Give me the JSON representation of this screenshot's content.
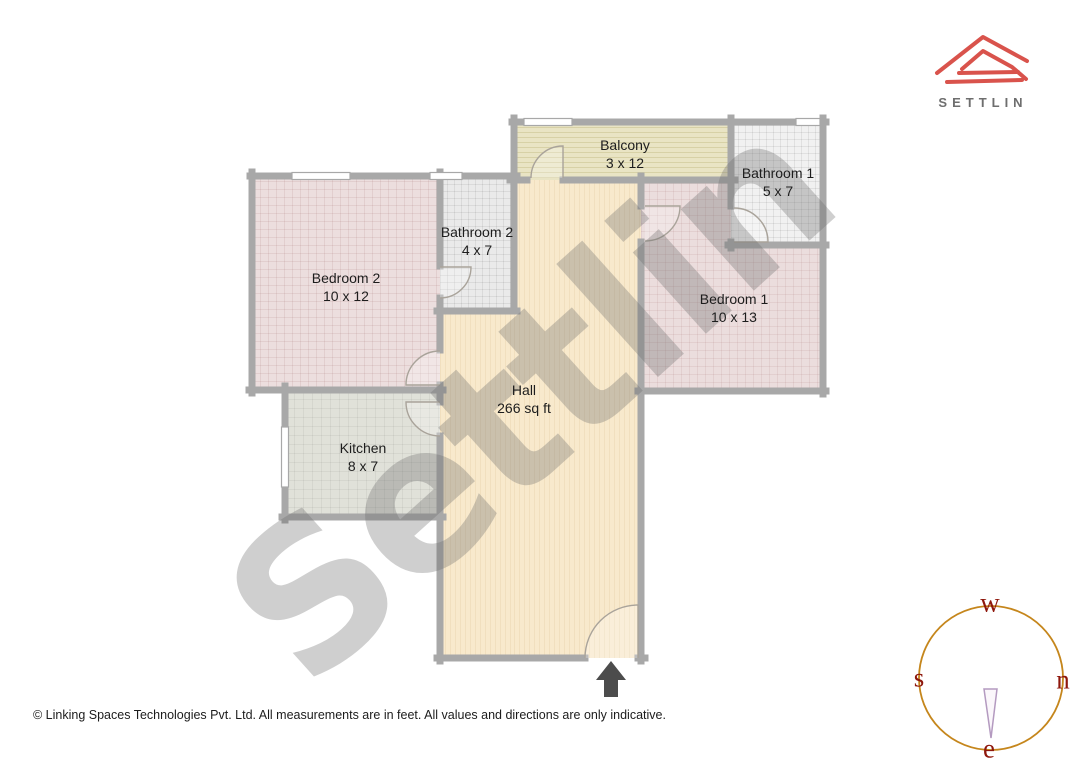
{
  "brand": {
    "name": "SETTLIN"
  },
  "watermark": "Settlin",
  "rooms": [
    {
      "name": "Balcony",
      "dims": "3 x 12"
    },
    {
      "name": "Bathroom 1",
      "dims": "5 x 7"
    },
    {
      "name": "Bathroom 2",
      "dims": "4 x 7"
    },
    {
      "name": "Bedroom 2",
      "dims": "10 x 12"
    },
    {
      "name": "Bedroom 1",
      "dims": "10 x 13"
    },
    {
      "name": "Kitchen",
      "dims": "8 x 7"
    },
    {
      "name": "Hall",
      "dims": "266 sq ft"
    }
  ],
  "compass": {
    "top": "w",
    "left": "s",
    "right": "n",
    "bottom": "e"
  },
  "footer": {
    "copyright": "© Linking Spaces Technologies Pvt. Ltd. All measurements are in feet. All values and directions are only indicative."
  },
  "colors": {
    "brand_red": "#d9534c",
    "brand_text": "#6e6e6e",
    "wall_gray": "#a8a8a8",
    "hall_fill": "#f8e9cc",
    "bedroom_fill": "#ecdede",
    "bathroom_fill": "#eeeeee",
    "balcony_fill": "#e9e4c4",
    "kitchen_fill": "#e0e1d9",
    "compass_circle": "#c5861c",
    "compass_letter": "#8e170c",
    "compass_needle": "#b49ac0",
    "entrance_arrow": "#4c4c4c"
  }
}
